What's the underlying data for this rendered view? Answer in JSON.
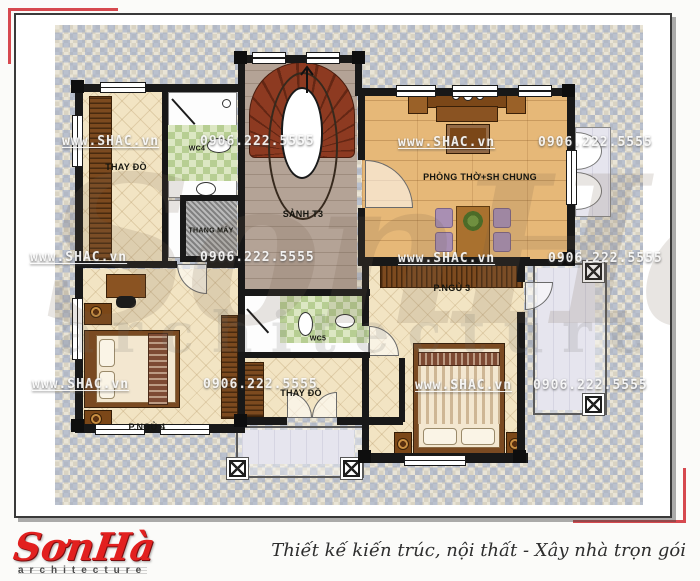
{
  "colors": {
    "accent_frame": "#d6494f",
    "logo_red": "#e2201f",
    "wall": "#181818",
    "stair_wood": "#8d3a21",
    "dining_wood": "#e6b878",
    "tile_cream": "#f2e4c3",
    "mosaic_blue": "#c9d2e2"
  },
  "rooms": {
    "dressing_top": {
      "label": "THAY ĐỒ"
    },
    "wc4": {
      "label": "WC4"
    },
    "elevator": {
      "label": "THANG MÁY"
    },
    "hall": {
      "label": "SẢNH T3"
    },
    "worship": {
      "label": "PHÒNG THỜ+SH CHUNG"
    },
    "bedroom3": {
      "label": "P.NGỦ 3"
    },
    "wc5": {
      "label": "WC5"
    },
    "dressing_bottom": {
      "label": "THAY ĐỒ"
    },
    "bedroom4": {
      "label": "P.NGỦ 4"
    }
  },
  "watermark": {
    "site": "www.SHAC.vn",
    "phone": "0906.222.5555",
    "ghost_title": "SonHa",
    "ghost_sub": "architecture",
    "rows": [
      {
        "t": "site",
        "x": 62,
        "y": 134
      },
      {
        "t": "phone",
        "x": 200,
        "y": 134
      },
      {
        "t": "site",
        "x": 398,
        "y": 135
      },
      {
        "t": "phone",
        "x": 538,
        "y": 135
      },
      {
        "t": "site",
        "x": 30,
        "y": 250
      },
      {
        "t": "phone",
        "x": 200,
        "y": 250
      },
      {
        "t": "site",
        "x": 398,
        "y": 251
      },
      {
        "t": "phone",
        "x": 548,
        "y": 251
      },
      {
        "t": "site",
        "x": 32,
        "y": 377
      },
      {
        "t": "phone",
        "x": 203,
        "y": 377
      },
      {
        "t": "site",
        "x": 415,
        "y": 378
      },
      {
        "t": "phone",
        "x": 533,
        "y": 378
      }
    ]
  },
  "footer": {
    "logo": "SơnHà",
    "logo_sub": "architecture",
    "slogan": "Thiết kế kiến trúc, nội thất - Xây nhà trọn gói"
  }
}
